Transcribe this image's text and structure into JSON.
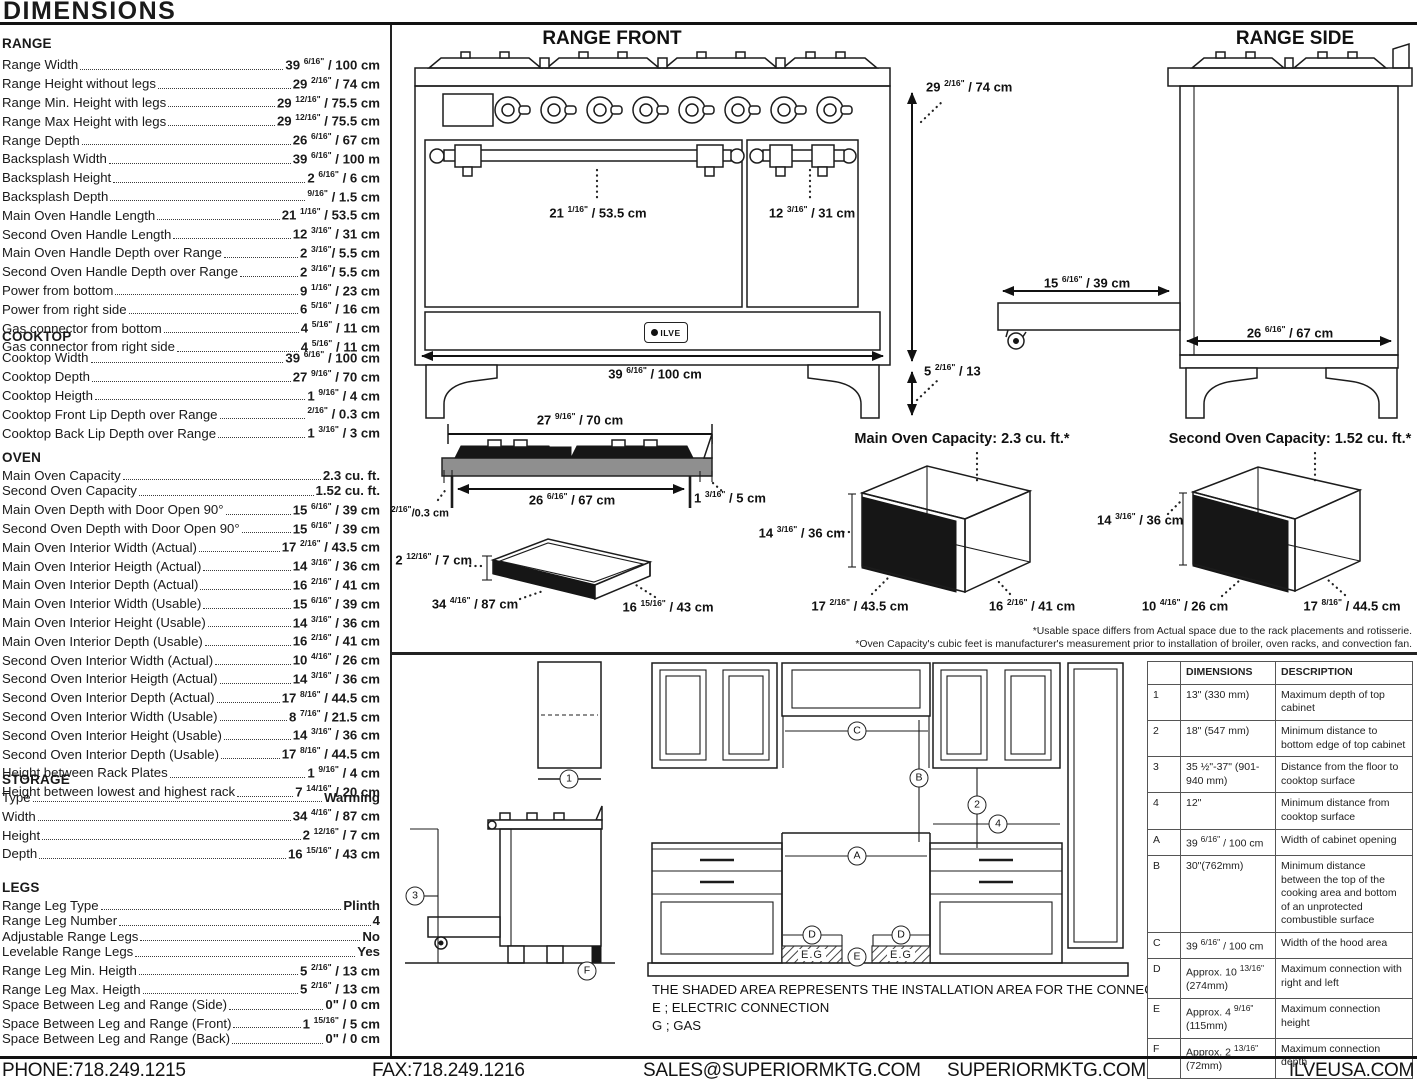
{
  "header": {
    "title": "DIMENSIONS"
  },
  "specs": {
    "range": {
      "heading": "RANGE",
      "rows": [
        {
          "label": "Range Width",
          "value": "39 6/16\" / 100 cm"
        },
        {
          "label": "Range Height without legs",
          "value": "29 2/16\" / 74 cm"
        },
        {
          "label": "Range Min. Height with legs",
          "value": "29 12/16\" / 75.5 cm"
        },
        {
          "label": "Range Max Height with legs",
          "value": "29 12/16\" / 75.5 cm"
        },
        {
          "label": "Range Depth",
          "value": "26 6/16\" / 67 cm"
        },
        {
          "label": "Backsplash Width",
          "value": "39 6/16\" / 100 m"
        },
        {
          "label": "Backsplash Height",
          "value": "2 6/16\" / 6 cm"
        },
        {
          "label": "Backsplash Depth",
          "value": "9/16\" / 1.5 cm"
        },
        {
          "label": "Main Oven Handle Length",
          "value": "21 1/16\" / 53.5 cm"
        },
        {
          "label": "Second Oven Handle Length",
          "value": "12 3/16\" / 31 cm"
        },
        {
          "label": "Main Oven Handle Depth over Range",
          "value": "2 3/16\"/ 5.5 cm"
        },
        {
          "label": "Second Oven Handle Depth over Range",
          "value": "2 3/16\"/ 5.5 cm"
        },
        {
          "label": "Power from bottom",
          "value": "9 1/16\" / 23 cm"
        },
        {
          "label": "Power from right side",
          "value": "6 5/16\" / 16 cm"
        },
        {
          "label": "Gas connector from bottom",
          "value": "4 5/16\" / 11 cm"
        },
        {
          "label": "Gas connector from right side",
          "value": "4 5/16\" / 11 cm"
        }
      ]
    },
    "cooktop": {
      "heading": "COOKTOP",
      "rows": [
        {
          "label": "Cooktop Width",
          "value": "39 6/16\" / 100 cm"
        },
        {
          "label": "Cooktop Depth",
          "value": "27 9/16\" / 70 cm"
        },
        {
          "label": "Cooktop Heigth",
          "value": "1 9/16\" / 4 cm"
        },
        {
          "label": "Cooktop Front Lip Depth over Range",
          "value": "2/16\" / 0.3 cm"
        },
        {
          "label": "Cooktop Back Lip Depth over Range",
          "value": "1 3/16\" / 3 cm"
        }
      ]
    },
    "oven": {
      "heading": "OVEN",
      "rows": [
        {
          "label": "Main Oven Capacity",
          "value": "2.3 cu. ft."
        },
        {
          "label": "Second Oven Capacity",
          "value": "1.52 cu. ft."
        },
        {
          "label": "Main Oven Depth with Door Open 90°",
          "value": "15 6/16\" / 39 cm"
        },
        {
          "label": "Second Oven Depth with Door Open 90°",
          "value": "15 6/16\" / 39 cm"
        },
        {
          "label": "Main Oven Interior Width (Actual)",
          "value": "17 2/16\" / 43.5 cm"
        },
        {
          "label": "Main Oven Interior Heigth (Actual)",
          "value": "14 3/16\" / 36 cm"
        },
        {
          "label": "Main Oven Interior Depth (Actual)",
          "value": "16 2/16\" / 41 cm"
        },
        {
          "label": "Main Oven Interior Width (Usable)",
          "value": "15 6/16\" / 39 cm"
        },
        {
          "label": "Main Oven Interior Height (Usable)",
          "value": "14 3/16\" / 36 cm"
        },
        {
          "label": "Main Oven Interior Depth (Usable)",
          "value": "16 2/16\" / 41 cm"
        },
        {
          "label": "Second Oven Interior Width (Actual)",
          "value": "10 4/16\" / 26 cm"
        },
        {
          "label": "Second Oven Interior Heigth (Actual)",
          "value": "14 3/16\" / 36 cm"
        },
        {
          "label": "Second Oven Interior Depth (Actual)",
          "value": "17 8/16\" / 44.5 cm"
        },
        {
          "label": "Second Oven Interior Width (Usable)",
          "value": "8 7/16\" / 21.5 cm"
        },
        {
          "label": "Second Oven Interior Height (Usable)",
          "value": "14 3/16\" / 36 cm"
        },
        {
          "label": "Second Oven Interior Depth (Usable)",
          "value": "17 8/16\" / 44.5 cm"
        },
        {
          "label": "Height between Rack Plates",
          "value": "1 9/16\" / 4 cm"
        },
        {
          "label": "Height between lowest and highest rack",
          "value": "7 14/16\" / 20 cm"
        }
      ]
    },
    "storage": {
      "heading": "STORAGE",
      "rows": [
        {
          "label": "Type",
          "value": "Warming"
        },
        {
          "label": "Width",
          "value": "34 4/16\" / 87 cm"
        },
        {
          "label": "Height",
          "value": "2 12/16\" / 7 cm"
        },
        {
          "label": "Depth",
          "value": "16 15/16\" / 43 cm"
        }
      ]
    },
    "legs": {
      "heading": "LEGS",
      "rows": [
        {
          "label": "Range Leg Type",
          "value": "Plinth"
        },
        {
          "label": "Range Leg Number",
          "value": "4"
        },
        {
          "label": "Adjustable Range Legs",
          "value": "No"
        },
        {
          "label": "Levelable Range Legs",
          "value": "Yes"
        },
        {
          "label": "Range Leg Min. Heigth",
          "value": "5 2/16\" / 13 cm"
        },
        {
          "label": "Range Leg Max. Heigth",
          "value": "5 2/16\" / 13 cm"
        },
        {
          "label": "Space Between Leg and Range (Side)",
          "value": "0\" / 0 cm"
        },
        {
          "label": "Space Between Leg and Range (Front)",
          "value": "1 15/16\" / 5 cm"
        },
        {
          "label": "Space Between Leg and Range (Back)",
          "value": "0\" / 0 cm"
        }
      ]
    }
  },
  "range_front": {
    "title": "RANGE FRONT",
    "logo_text": "ILVE",
    "width": "39 6/16\" / 100 cm",
    "height": "29 2/16\" / 74 cm",
    "leg_height": "5 2/16\" / 13",
    "main_handle": "21 1/16\" / 53.5 cm",
    "second_handle": "12 3/16\" / 31 cm"
  },
  "range_side": {
    "title": "RANGE SIDE",
    "door_open": "15 6/16\" / 39 cm",
    "depth": "26 6/16\" / 67 cm"
  },
  "cooktop_diagram": {
    "width": "27 9/16\" / 70 cm",
    "inner_width": "26 6/16\" / 67 cm",
    "front_lip": "2/16\"/0.3 cm",
    "back_lip": "1 3/16\" / 5 cm"
  },
  "storage_diagram": {
    "height": "2 12/16\" / 7 cm",
    "width": "34 4/16\" / 87 cm",
    "depth": "16 15/16\" / 43 cm"
  },
  "main_oven_diagram": {
    "title": "Main Oven Capacity: 2.3 cu. ft.*",
    "height": "14 3/16\" / 36 cm",
    "width": "17 2/16\" / 43.5 cm",
    "depth": "16 2/16\" / 41 cm"
  },
  "second_oven_diagram": {
    "title": "Second Oven Capacity: 1.52 cu. ft.*",
    "height": "14 3/16\" / 36 cm",
    "width": "10 4/16\" / 26 cm",
    "depth": "17 8/16\" / 44.5 cm"
  },
  "footnotes": {
    "line1": "*Usable space differs from Actual space due to the rack placements and rotisserie.",
    "line2": "*Oven Capacity's cubic feet is manufacturer's measurement prior to installation of broiler, oven racks, and convection fan."
  },
  "installation": {
    "note": "THE SHADED AREA REPRESENTS THE INSTALLATION AREA FOR THE CONNECTIONS;",
    "legend_electric": "E ; ELECTRIC CONNECTION",
    "legend_gas": "G ; GAS",
    "shaded_label": "E.G",
    "markers": {
      "m1": "1",
      "m2": "2",
      "m3": "3",
      "m4": "4",
      "mA": "A",
      "mB": "B",
      "mC": "C",
      "mD": "D",
      "mE": "E",
      "mF": "F"
    }
  },
  "table": {
    "headers": [
      "",
      "DIMENSIONS",
      "DESCRIPTION"
    ],
    "rows": [
      {
        "key": "1",
        "dim": "13\" (330 mm)",
        "desc": "Maximum depth of top cabinet"
      },
      {
        "key": "2",
        "dim": "18\" (547 mm)",
        "desc": "Minimum distance to bottom edge of top cabinet"
      },
      {
        "key": "3",
        "dim": "35 ½\"-37\" (901-940 mm)",
        "desc": "Distance from the floor to cooktop surface"
      },
      {
        "key": "4",
        "dim": "12\"",
        "desc": "Minimum distance from cooktop surface"
      },
      {
        "key": "A",
        "dim": "39 6/16\" / 100 cm",
        "desc": "Width of cabinet opening"
      },
      {
        "key": "B",
        "dim": "30\"(762mm)",
        "desc": "Minimum distance between the top of the cooking area and bottom of an unprotected combustible surface"
      },
      {
        "key": "C",
        "dim": "39 6/16\" / 100 cm",
        "desc": "Width of the hood area"
      },
      {
        "key": "D",
        "dim": "Approx. 10 13/16\" (274mm)",
        "desc": "Maximum connection with right and left"
      },
      {
        "key": "E",
        "dim": "Approx. 4 9/16\" (115mm)",
        "desc": "Maximum connection height"
      },
      {
        "key": "F",
        "dim": "Approx. 2 13/16\" (72mm)",
        "desc": "Maximum connection depth"
      }
    ]
  },
  "footer": {
    "phone": "PHONE:718.249.1215",
    "fax": "FAX:718.249.1216",
    "email": "SALES@SUPERIORMKTG.COM",
    "website": "SUPERIORMKTG.COM",
    "brand_website": "ILVEUSA.COM"
  },
  "colors": {
    "ink": "#1a1a1a",
    "slab_gray": "#8f8f8f",
    "fill_black": "#161616"
  }
}
